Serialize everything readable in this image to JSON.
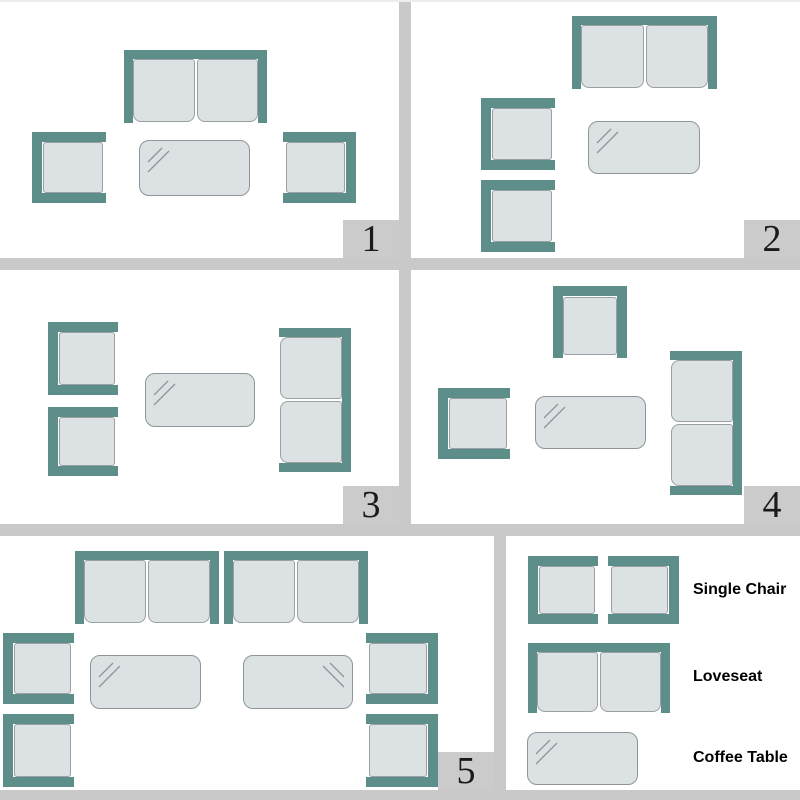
{
  "colors": {
    "frame_teal": "#5e8e89",
    "cushion_fill": "#dce1e3",
    "cushion_border": "#9aa0a2",
    "table_fill": "#dce1e3",
    "table_border": "#8e9699",
    "divider_gray": "#c9c9c9",
    "number_box_gray": "#cbcbcb",
    "number_text": "#1a1a1a",
    "label_text": "#000000"
  },
  "panels": [
    {
      "number": "1",
      "furniture": [
        {
          "type": "loveseat",
          "facing": "down",
          "name": "loveseat",
          "x": 124,
          "y": 50,
          "w": 143,
          "h": 73
        },
        {
          "type": "chair",
          "facing": "right",
          "name": "single-chair",
          "x": 32,
          "y": 132,
          "w": 74,
          "h": 71
        },
        {
          "type": "table",
          "shine": "tl",
          "name": "coffee-table",
          "x": 139,
          "y": 140,
          "w": 111,
          "h": 56
        },
        {
          "type": "chair",
          "facing": "left",
          "name": "single-chair",
          "x": 283,
          "y": 132,
          "w": 73,
          "h": 71
        }
      ]
    },
    {
      "number": "2",
      "furniture": [
        {
          "type": "loveseat",
          "facing": "down",
          "name": "loveseat",
          "x": 161,
          "y": 16,
          "w": 145,
          "h": 73
        },
        {
          "type": "chair",
          "facing": "right",
          "name": "single-chair",
          "x": 70,
          "y": 98,
          "w": 74,
          "h": 72
        },
        {
          "type": "chair",
          "facing": "right",
          "name": "single-chair",
          "x": 70,
          "y": 180,
          "w": 74,
          "h": 72
        },
        {
          "type": "table",
          "shine": "tl",
          "name": "coffee-table",
          "x": 177,
          "y": 121,
          "w": 112,
          "h": 53
        }
      ]
    },
    {
      "number": "3",
      "furniture": [
        {
          "type": "chair",
          "facing": "right",
          "name": "single-chair",
          "x": 48,
          "y": 52,
          "w": 70,
          "h": 73
        },
        {
          "type": "chair",
          "facing": "right",
          "name": "single-chair",
          "x": 48,
          "y": 137,
          "w": 70,
          "h": 69
        },
        {
          "type": "table",
          "shine": "tl",
          "name": "coffee-table",
          "x": 145,
          "y": 103,
          "w": 110,
          "h": 54
        },
        {
          "type": "loveseat",
          "facing": "left",
          "name": "loveseat",
          "x": 279,
          "y": 58,
          "w": 72,
          "h": 144
        }
      ]
    },
    {
      "number": "4",
      "furniture": [
        {
          "type": "chair",
          "facing": "down",
          "name": "single-chair",
          "x": 142,
          "y": 16,
          "w": 74,
          "h": 72
        },
        {
          "type": "chair",
          "facing": "right",
          "name": "single-chair",
          "x": 27,
          "y": 118,
          "w": 72,
          "h": 71
        },
        {
          "type": "table",
          "shine": "tl",
          "name": "coffee-table",
          "x": 124,
          "y": 126,
          "w": 111,
          "h": 53
        },
        {
          "type": "loveseat",
          "facing": "left",
          "name": "loveseat",
          "x": 259,
          "y": 81,
          "w": 72,
          "h": 144
        }
      ]
    },
    {
      "number": "5",
      "furniture": [
        {
          "type": "loveseat",
          "facing": "down",
          "name": "loveseat",
          "x": 75,
          "y": 15,
          "w": 144,
          "h": 73
        },
        {
          "type": "loveseat",
          "facing": "down",
          "name": "loveseat",
          "x": 224,
          "y": 15,
          "w": 144,
          "h": 73
        },
        {
          "type": "chair",
          "facing": "right",
          "name": "single-chair",
          "x": 3,
          "y": 97,
          "w": 71,
          "h": 71
        },
        {
          "type": "chair",
          "facing": "right",
          "name": "single-chair",
          "x": 3,
          "y": 178,
          "w": 71,
          "h": 73
        },
        {
          "type": "table",
          "shine": "tl",
          "name": "coffee-table",
          "x": 90,
          "y": 119,
          "w": 111,
          "h": 54
        },
        {
          "type": "table",
          "shine": "tr",
          "name": "coffee-table",
          "x": 243,
          "y": 119,
          "w": 110,
          "h": 54
        },
        {
          "type": "chair",
          "facing": "left",
          "name": "single-chair",
          "x": 366,
          "y": 97,
          "w": 72,
          "h": 71
        },
        {
          "type": "chair",
          "facing": "left",
          "name": "single-chair",
          "x": 366,
          "y": 178,
          "w": 72,
          "h": 73
        }
      ]
    }
  ],
  "legend": {
    "furniture": [
      {
        "type": "chair",
        "facing": "right",
        "name": "legend-single-chair",
        "x": 22,
        "y": 20,
        "w": 70,
        "h": 68
      },
      {
        "type": "chair",
        "facing": "left",
        "name": "legend-single-chair",
        "x": 102,
        "y": 20,
        "w": 71,
        "h": 68
      },
      {
        "type": "loveseat",
        "facing": "down",
        "name": "legend-loveseat",
        "x": 22,
        "y": 107,
        "w": 142,
        "h": 70
      },
      {
        "type": "table",
        "shine": "tl",
        "name": "legend-coffee-table",
        "x": 21,
        "y": 196,
        "w": 111,
        "h": 53
      }
    ],
    "items": [
      {
        "label": "Single Chair"
      },
      {
        "label": "Loveseat"
      },
      {
        "label": "Coffee Table"
      }
    ]
  }
}
